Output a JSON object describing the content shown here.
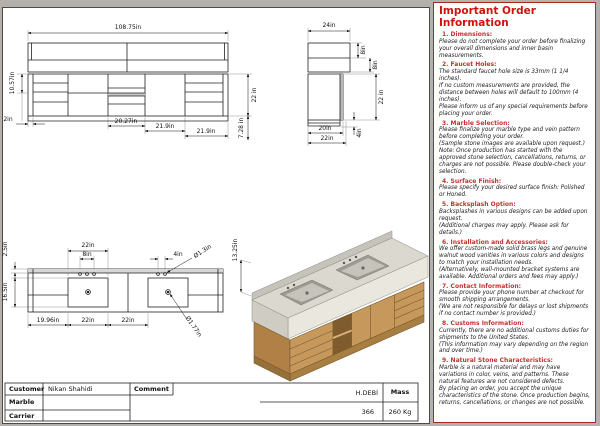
{
  "colors": {
    "accent_red": "#c23230",
    "wood": "#c6985c",
    "marble": "#dbd8cf",
    "line": "#222222"
  },
  "views": {
    "front": {
      "total_width": "108.75in",
      "left_height": "10.57in",
      "left_overhang": "2in",
      "w1": "20.27in",
      "w2": "21.9in",
      "w3": "21.9in",
      "right_height": "22 in",
      "lower_right": "7.28 in"
    },
    "side": {
      "top_width": "24in",
      "band1": "8in",
      "band2": "8in",
      "cab_height": "22 in",
      "base_height": "4in",
      "depth_cabinet": "20in",
      "depth_total": "22in"
    },
    "plan": {
      "basin_width": "22in",
      "hole_span": "8in",
      "hole_gap": "4in",
      "back_offset": "2.5in",
      "basin_depth": "16.5in",
      "faucet_dia": "Ø1.3in",
      "drain_dia": "Ø1.77in",
      "left_offset": "19.96in",
      "basin_dim": "22in",
      "gap_dim": "22in"
    },
    "iso": {
      "total_height": "13.25in"
    }
  },
  "title_block": {
    "customer_label": "Customer",
    "customer_value": "Nikan Shahidi",
    "comment_label": "Comment",
    "marble_label": "Marble",
    "carrier_label": "Carrier",
    "flow_label": "H.DEBİ",
    "flow_value": "366",
    "mass_label": "Mass",
    "mass_value": "260 Kg"
  },
  "info_panel": {
    "title": "Important Order Information",
    "sections": [
      {
        "heading": "1. Dimensions:",
        "body": "Please do not complete your order before finalizing your overall dimensions and inner basin measurements."
      },
      {
        "heading": "2. Faucet Holes:",
        "body": "The standard faucet hole size is 33mm (1 1/4 inches).\nIf no custom measurements are provided, the distance between holes will default to 100mm (4 inches).\nPlease inform us of any special requirements before placing your order."
      },
      {
        "heading": "3. Marble Selection:",
        "body": "Please finalize your marble type and vein pattern before completing your order.\n(Sample stone images are available upon request.)\nNote: Once production has started with the approved stone selection, cancellations, returns, or charges are not possible. Please double-check your selection."
      },
      {
        "heading": "4. Surface Finish:",
        "body": "Please specify your desired surface finish: Polished or Honed."
      },
      {
        "heading": "5. Backsplash Option:",
        "body": "Backsplashes in various designs can be added upon request.\n(Additional charges may apply. Please ask for details.)"
      },
      {
        "heading": "6. Installation and Accessories:",
        "body": "We offer custom-made solid brass legs and genuine walnut wood vanities in various colors and designs to match your installation needs.\n(Alternatively, wall-mounted bracket systems are available. Additional orders and fees may apply.)"
      },
      {
        "heading": "7. Contact Information:",
        "body": "Please provide your phone number at checkout for smooth shipping arrangements.\n(We are not responsible for delays or lost shipments if no contact number is provided.)"
      },
      {
        "heading": "8. Customs Information:",
        "body": "Currently, there are no additional customs duties for shipments to the United States.\n(This information may vary depending on the region and over time.)"
      },
      {
        "heading": "9. Natural Stone Characteristics:",
        "body": "Marble is a natural material and may have variations in color, veins, and patterns. These natural features are not considered defects.\nBy placing an order, you accept the unique characteristics of the stone. Once production begins, returns, cancellations, or changes are not possible."
      }
    ]
  }
}
